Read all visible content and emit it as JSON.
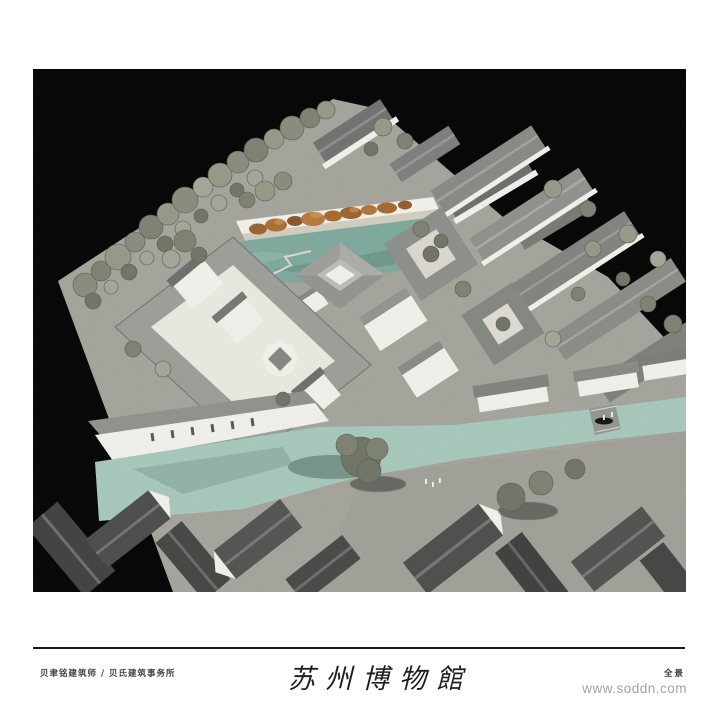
{
  "board": {
    "footer": {
      "credit": "贝聿铭建筑师 / 贝氏建筑事务所",
      "title": "苏州博物館",
      "view_label": "全景",
      "watermark": "www.soddn.com"
    },
    "photo_colors": {
      "background": "#030303",
      "paving": "#a2a29b",
      "building_white": "#efeee8",
      "roof_gray": "#8b8e89",
      "roof_dark": "#454745",
      "tree_olive": "#868b7d",
      "pond_teal": "#7da79b",
      "canal_green": "#a4c6b8",
      "rock_orange": "#a5672e"
    }
  }
}
